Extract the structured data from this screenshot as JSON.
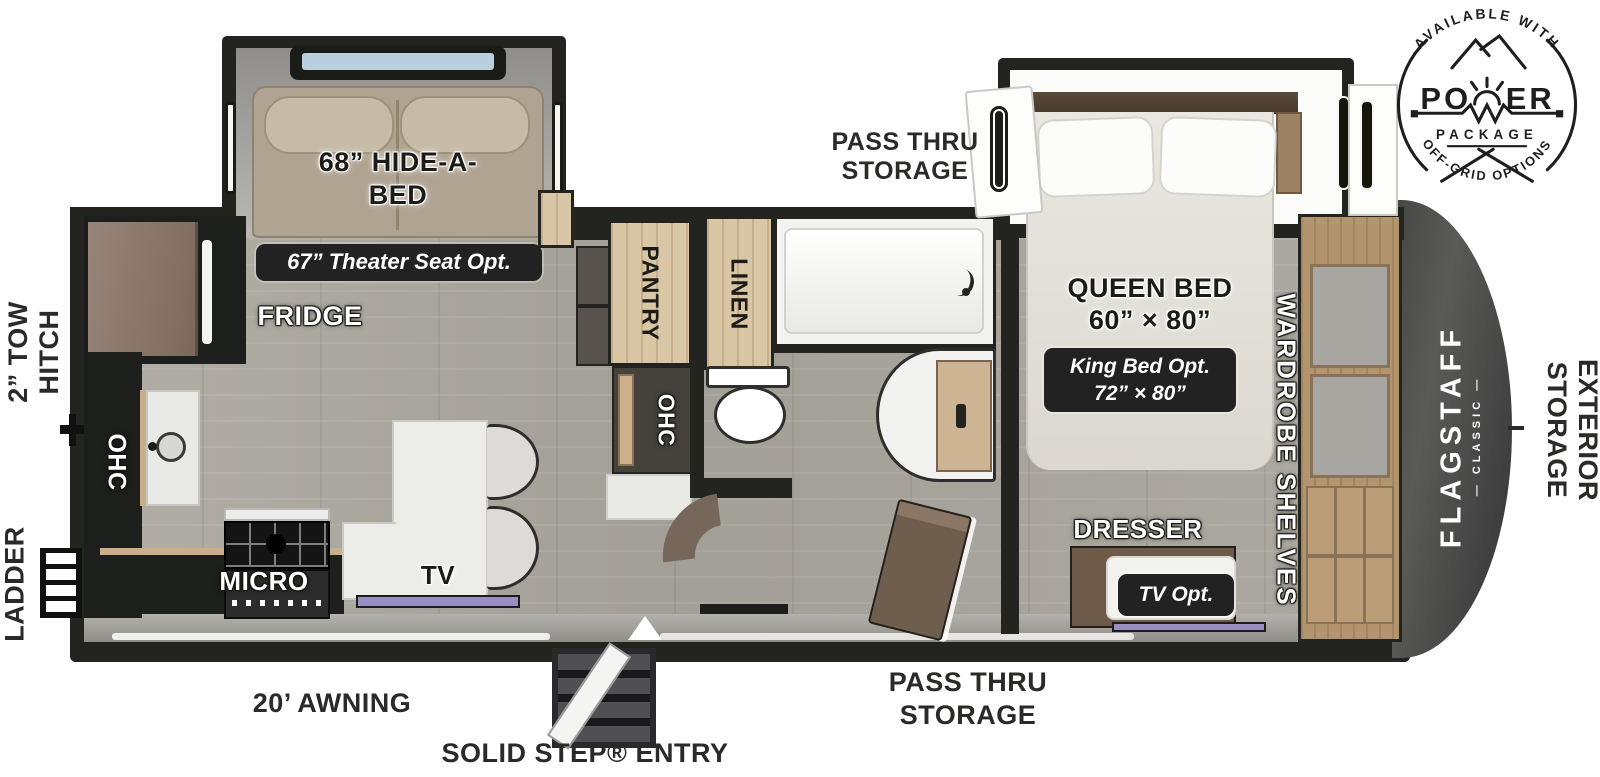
{
  "power_badge": {
    "arc_top": "AVAILABLE WITH",
    "title_left": "PO",
    "title_right": "ER",
    "subtitle": "PACKAGE",
    "arc_bottom": "OFF-GRID OPTIONS"
  },
  "brand": {
    "name": "FLAGSTAFF",
    "series": "— CLASSIC —"
  },
  "exterior": {
    "tow_hitch": {
      "line1": "2” TOW",
      "line2": "HITCH"
    },
    "ladder": "LADDER",
    "exterior_storage": {
      "line1": "EXTERIOR",
      "line2": "STORAGE"
    },
    "pass_thru_top": {
      "line1": "PASS THRU",
      "line2": "STORAGE"
    },
    "pass_thru_bottom": {
      "line1": "PASS THRU",
      "line2": "STORAGE"
    },
    "awning": "20’ AWNING",
    "entry": "SOLID STEP® ENTRY"
  },
  "living_area": {
    "hide_a_bed": {
      "line1": "68” HIDE-A-",
      "line2": "BED"
    },
    "theater_seat_option": "67” Theater Seat Opt.",
    "fridge": "FRIDGE",
    "pantry": "PANTRY",
    "pantry_ohc": "OHC",
    "kitchen_ohc": "OHC",
    "micro": "MICRO",
    "tv": "TV"
  },
  "bathroom": {
    "linen": "LINEN"
  },
  "bedroom": {
    "queen_bed": {
      "line1": "QUEEN BED",
      "line2": "60” × 80”"
    },
    "king_bed_option": {
      "line1": "King Bed Opt.",
      "line2": "72” × 80”"
    },
    "wardrobe_shelves": "WARDROBE SHELVES",
    "dresser": "DRESSER",
    "tv_option": "TV Opt."
  },
  "colors": {
    "wall": "#23241f",
    "floor": "#a9a69e",
    "wood": "#d9c6a5",
    "tv_accent": "#998fc2",
    "badge_bg": "#232222",
    "cap": "#4a4a48"
  }
}
